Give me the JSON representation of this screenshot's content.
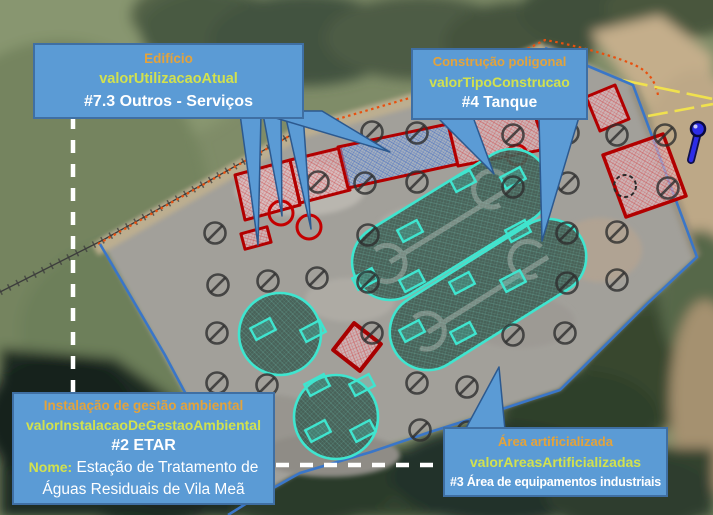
{
  "callouts": {
    "edificio": {
      "title": "Edifício",
      "attribute": "valorUtilizacaoAtual",
      "value": "#7.3 Outros - Serviços"
    },
    "construcao": {
      "title": "Construção poligonal",
      "attribute": "valorTipoConstrucao",
      "value": "#4 Tanque"
    },
    "instalacao": {
      "title": "Instalação de gestão ambiental",
      "attribute": "valorInstalacaoDeGestaoAmbiental",
      "value": "#2 ETAR",
      "name_label": "Nome:",
      "name_value": "Estação de Tratamento de Águas Residuais de Vila Meã"
    },
    "area": {
      "title": "Área artificializada",
      "attribute": "valorAreasArtificializadas",
      "value": "#3 Área de equipamentos industriais"
    }
  },
  "colors": {
    "callout_fill": "#5b9bd5",
    "callout_border": "#3f6fa3",
    "title_orange": "#e3a33c",
    "attribute_lime": "#d2e14e",
    "value_white": "#ffffff",
    "tank_outline_cyan": "#3fe5cf",
    "building_outline_red": "#b20000",
    "parcel_boundary_blue": "#3a76c8",
    "fence_dotted_orange": "#e8500f",
    "road_line_yellow": "#f0e14e",
    "survey_dash_white": "#ffffff",
    "map_pin_blue": "#2d2de8",
    "prohibition_symbol": "#2e2e2e"
  }
}
